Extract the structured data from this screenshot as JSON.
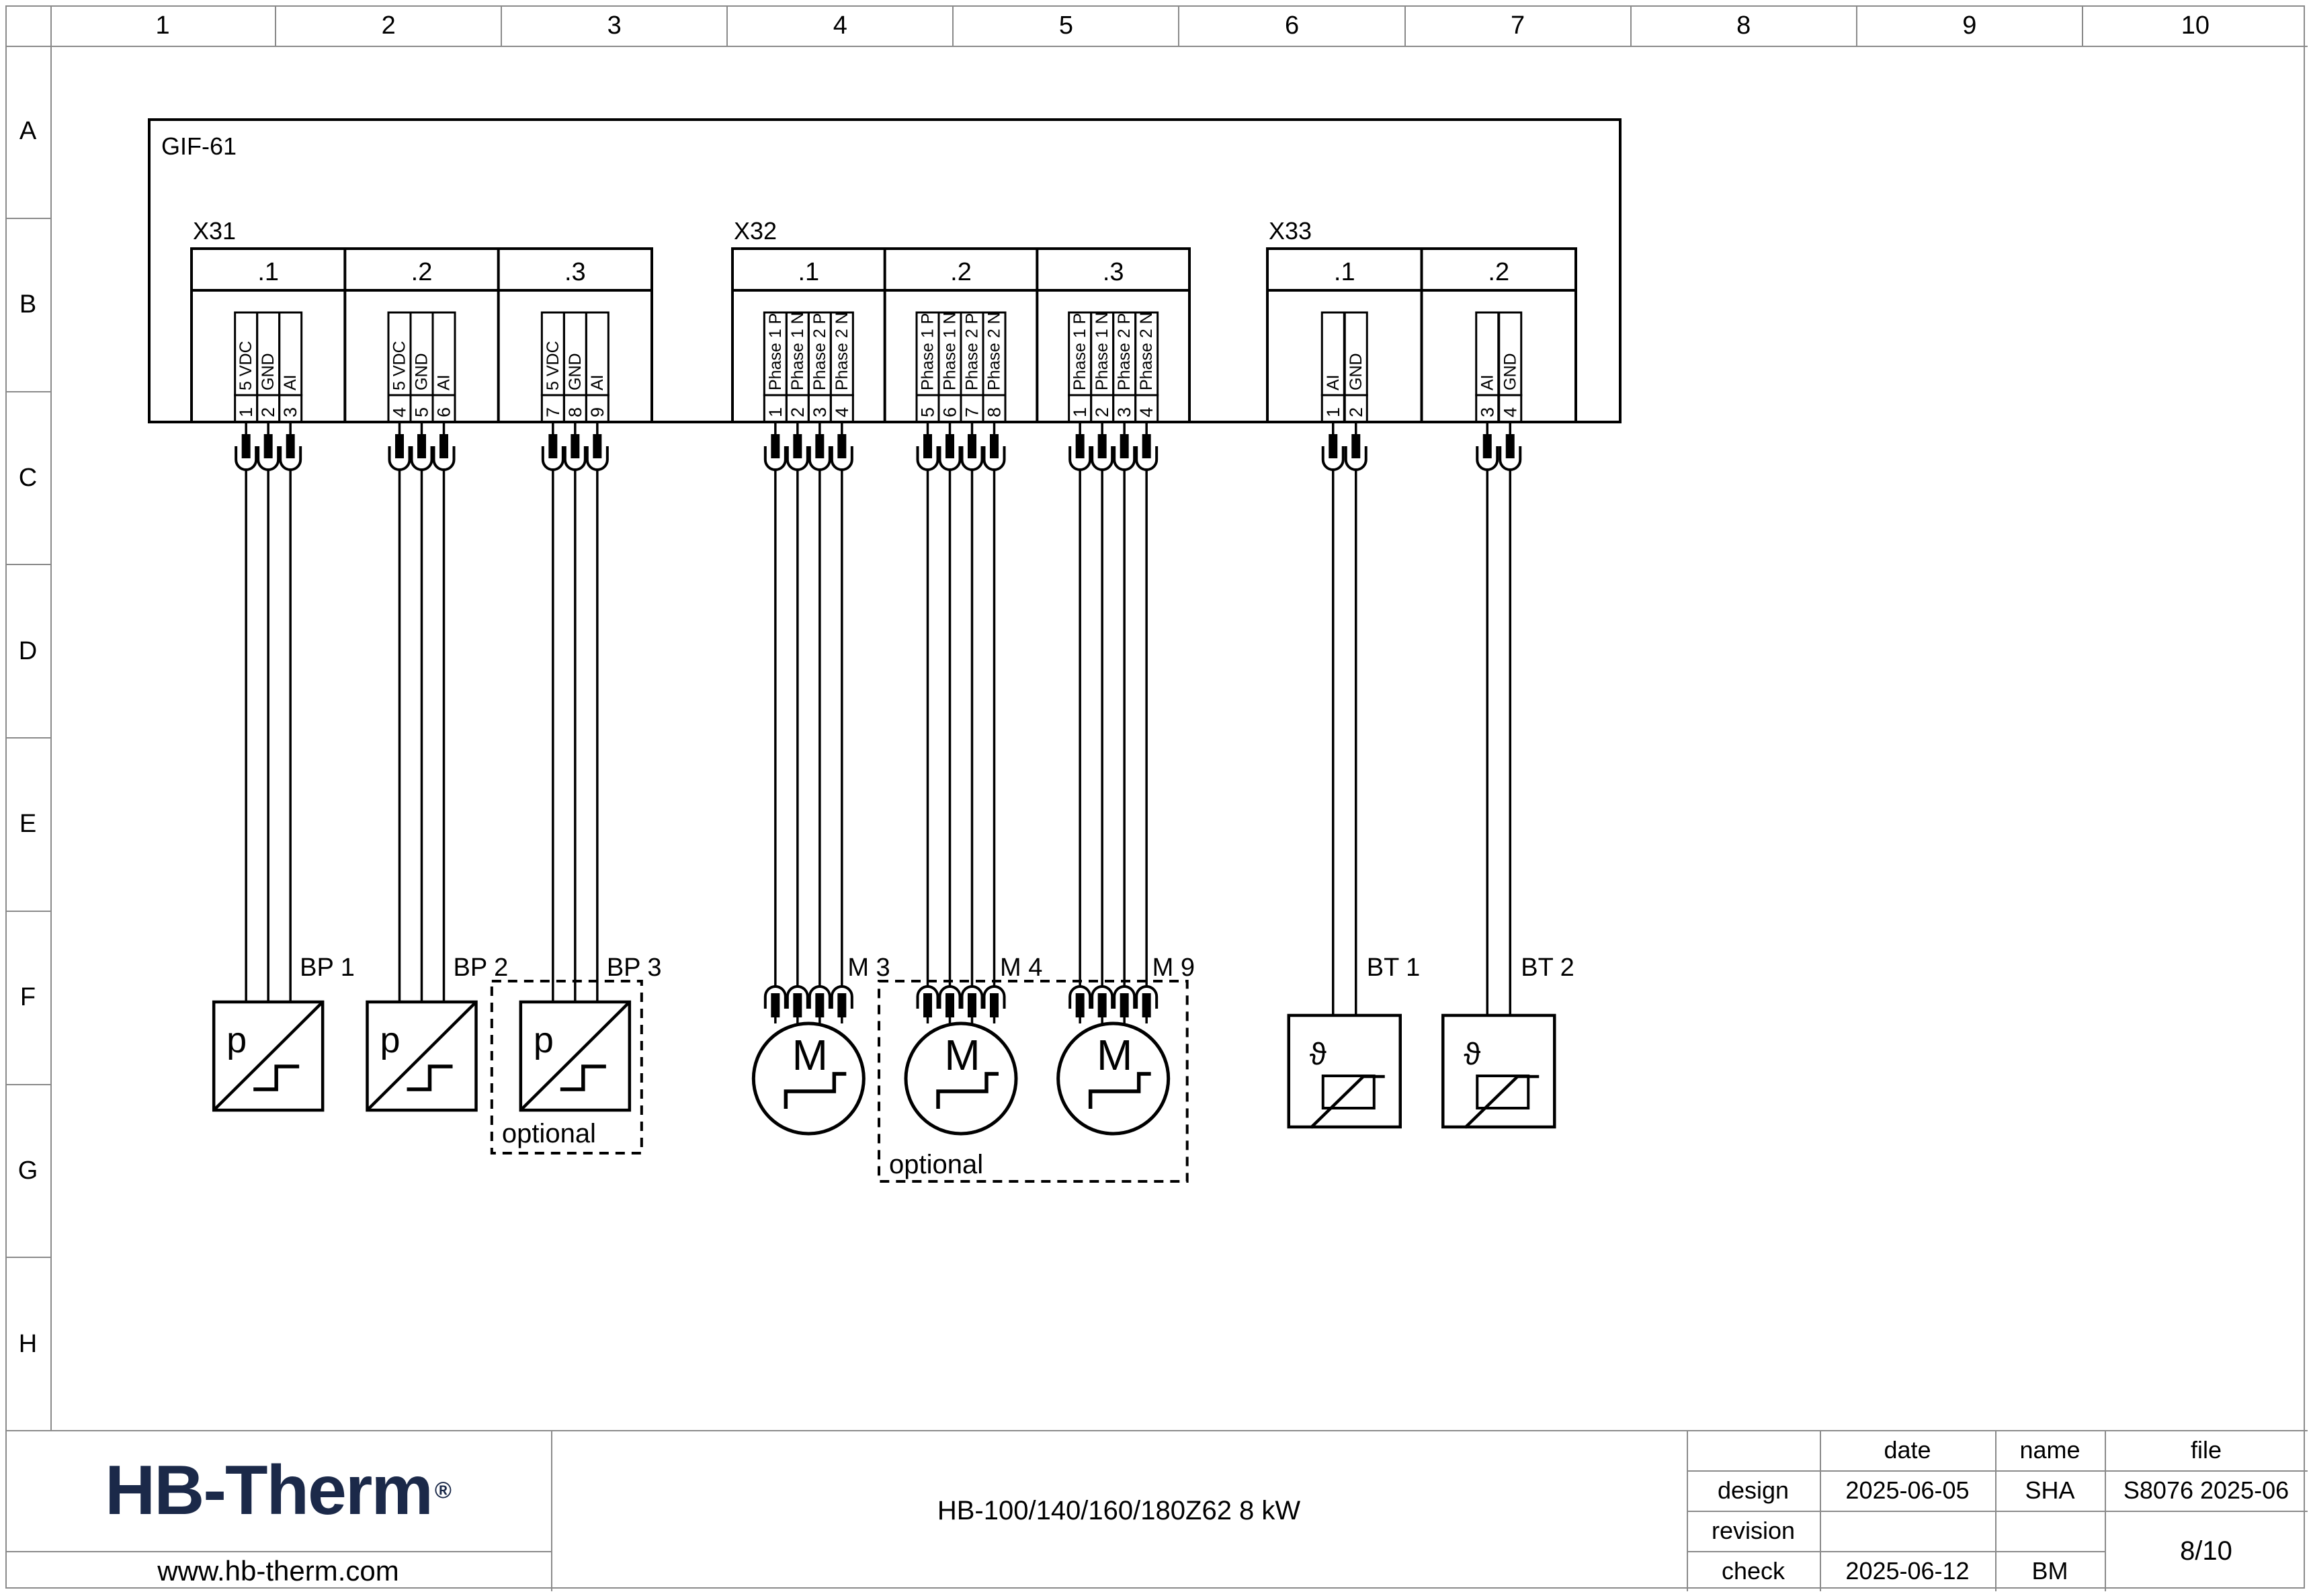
{
  "sheet": {
    "grid_columns": [
      "1",
      "2",
      "3",
      "4",
      "5",
      "6",
      "7",
      "8",
      "9",
      "10"
    ],
    "grid_rows": [
      "A",
      "B",
      "C",
      "D",
      "E",
      "F",
      "G",
      "H"
    ]
  },
  "diagram": {
    "enclosure_label": "GIF-61",
    "optional_label": "optional",
    "device_symbols": {
      "pressure": "p",
      "motor": "M",
      "temperature": "ϑ"
    },
    "connectors": [
      {
        "name": "X31",
        "groups": [
          {
            "label": ".1",
            "pins": [
              {
                "no": "1",
                "signal": "5 VDC"
              },
              {
                "no": "2",
                "signal": "GND"
              },
              {
                "no": "3",
                "signal": "AI"
              }
            ],
            "device": {
              "tag": "BP 1",
              "type": "pressure",
              "optional": false
            }
          },
          {
            "label": ".2",
            "pins": [
              {
                "no": "4",
                "signal": "5 VDC"
              },
              {
                "no": "5",
                "signal": "GND"
              },
              {
                "no": "6",
                "signal": "AI"
              }
            ],
            "device": {
              "tag": "BP 2",
              "type": "pressure",
              "optional": false
            }
          },
          {
            "label": ".3",
            "pins": [
              {
                "no": "7",
                "signal": "5 VDC"
              },
              {
                "no": "8",
                "signal": "GND"
              },
              {
                "no": "9",
                "signal": "AI"
              }
            ],
            "device": {
              "tag": "BP 3",
              "type": "pressure",
              "optional": true
            }
          }
        ]
      },
      {
        "name": "X32",
        "groups": [
          {
            "label": ".1",
            "pins": [
              {
                "no": "1",
                "signal": "Phase 1 P"
              },
              {
                "no": "2",
                "signal": "Phase 1 N"
              },
              {
                "no": "3",
                "signal": "Phase 2 P"
              },
              {
                "no": "4",
                "signal": "Phase 2 N"
              }
            ],
            "device": {
              "tag": "M 3",
              "type": "motor",
              "optional": false
            }
          },
          {
            "label": ".2",
            "pins": [
              {
                "no": "5",
                "signal": "Phase 1 P"
              },
              {
                "no": "6",
                "signal": "Phase 1 N"
              },
              {
                "no": "7",
                "signal": "Phase 2 P"
              },
              {
                "no": "8",
                "signal": "Phase 2 N"
              }
            ],
            "device": {
              "tag": "M 4",
              "type": "motor",
              "optional": true
            }
          },
          {
            "label": ".3",
            "pins": [
              {
                "no": "1",
                "signal": "Phase 1 P"
              },
              {
                "no": "2",
                "signal": "Phase 1 N"
              },
              {
                "no": "3",
                "signal": "Phase 2 P"
              },
              {
                "no": "4",
                "signal": "Phase 2 N"
              }
            ],
            "device": {
              "tag": "M 9",
              "type": "motor",
              "optional": true
            }
          }
        ]
      },
      {
        "name": "X33",
        "groups": [
          {
            "label": ".1",
            "pins": [
              {
                "no": "1",
                "signal": "AI"
              },
              {
                "no": "2",
                "signal": "GND"
              }
            ],
            "device": {
              "tag": "BT 1",
              "type": "temperature",
              "optional": false
            }
          },
          {
            "label": ".2",
            "pins": [
              {
                "no": "3",
                "signal": "AI"
              },
              {
                "no": "4",
                "signal": "GND"
              }
            ],
            "device": {
              "tag": "BT 2",
              "type": "temperature",
              "optional": false
            }
          }
        ]
      }
    ]
  },
  "title_block": {
    "brand": {
      "logo_text": "HB-Therm",
      "registered_mark": "®",
      "website": "www.hb-therm.com",
      "logo_color": "#1b2949"
    },
    "drawing_title": "HB-100/140/160/180Z62 8 kW",
    "meta": {
      "col_headers": {
        "date": "date",
        "name": "name",
        "file": "file"
      },
      "rows": [
        {
          "label": "design",
          "date": "2025-06-05",
          "name": "SHA",
          "file": "S8076 2025-06"
        },
        {
          "label": "revision",
          "date": "",
          "name": "",
          "file": ""
        },
        {
          "label": "check",
          "date": "2025-06-12",
          "name": "BM",
          "file": ""
        }
      ],
      "page": "8/10"
    }
  }
}
